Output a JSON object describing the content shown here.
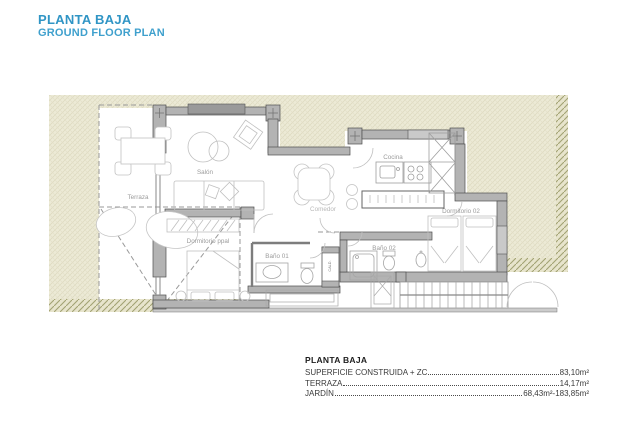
{
  "header": {
    "title": "PLANTA BAJA",
    "subtitle": "GROUND FLOOR PLAN"
  },
  "plan": {
    "rooms": {
      "terraza": {
        "label": "Terraza"
      },
      "salon": {
        "label": "Salón"
      },
      "cocina": {
        "label": "Cocina"
      },
      "comedor": {
        "label": "Comedor"
      },
      "dormitorio_ppal": {
        "label": "Dormitorio ppal"
      },
      "bano_01": {
        "label": "Baño 01"
      },
      "bano_02": {
        "label": "Baño 02"
      },
      "dormitorio_02": {
        "label": "Dormitorio 02"
      },
      "caldera": {
        "label": "CALD."
      }
    }
  },
  "legend": {
    "heading": "PLANTA BAJA",
    "rows": [
      {
        "label": "SUPERFICIE CONSTRUIDA + ZC",
        "value": "83,10m²"
      },
      {
        "label": "TERRAZA",
        "value": "14,17m²"
      },
      {
        "label": "JARDÍN",
        "value": "68,43m²-183,85m²"
      }
    ]
  },
  "colors": {
    "accent_blue": "#3095c5",
    "garden_fill": "#ecead6",
    "slope_hatch": "#a2a373",
    "wall_fill": "#b3b3b3",
    "wall_stroke": "#4f4f4f",
    "label_gray": "#9b9b9b"
  }
}
